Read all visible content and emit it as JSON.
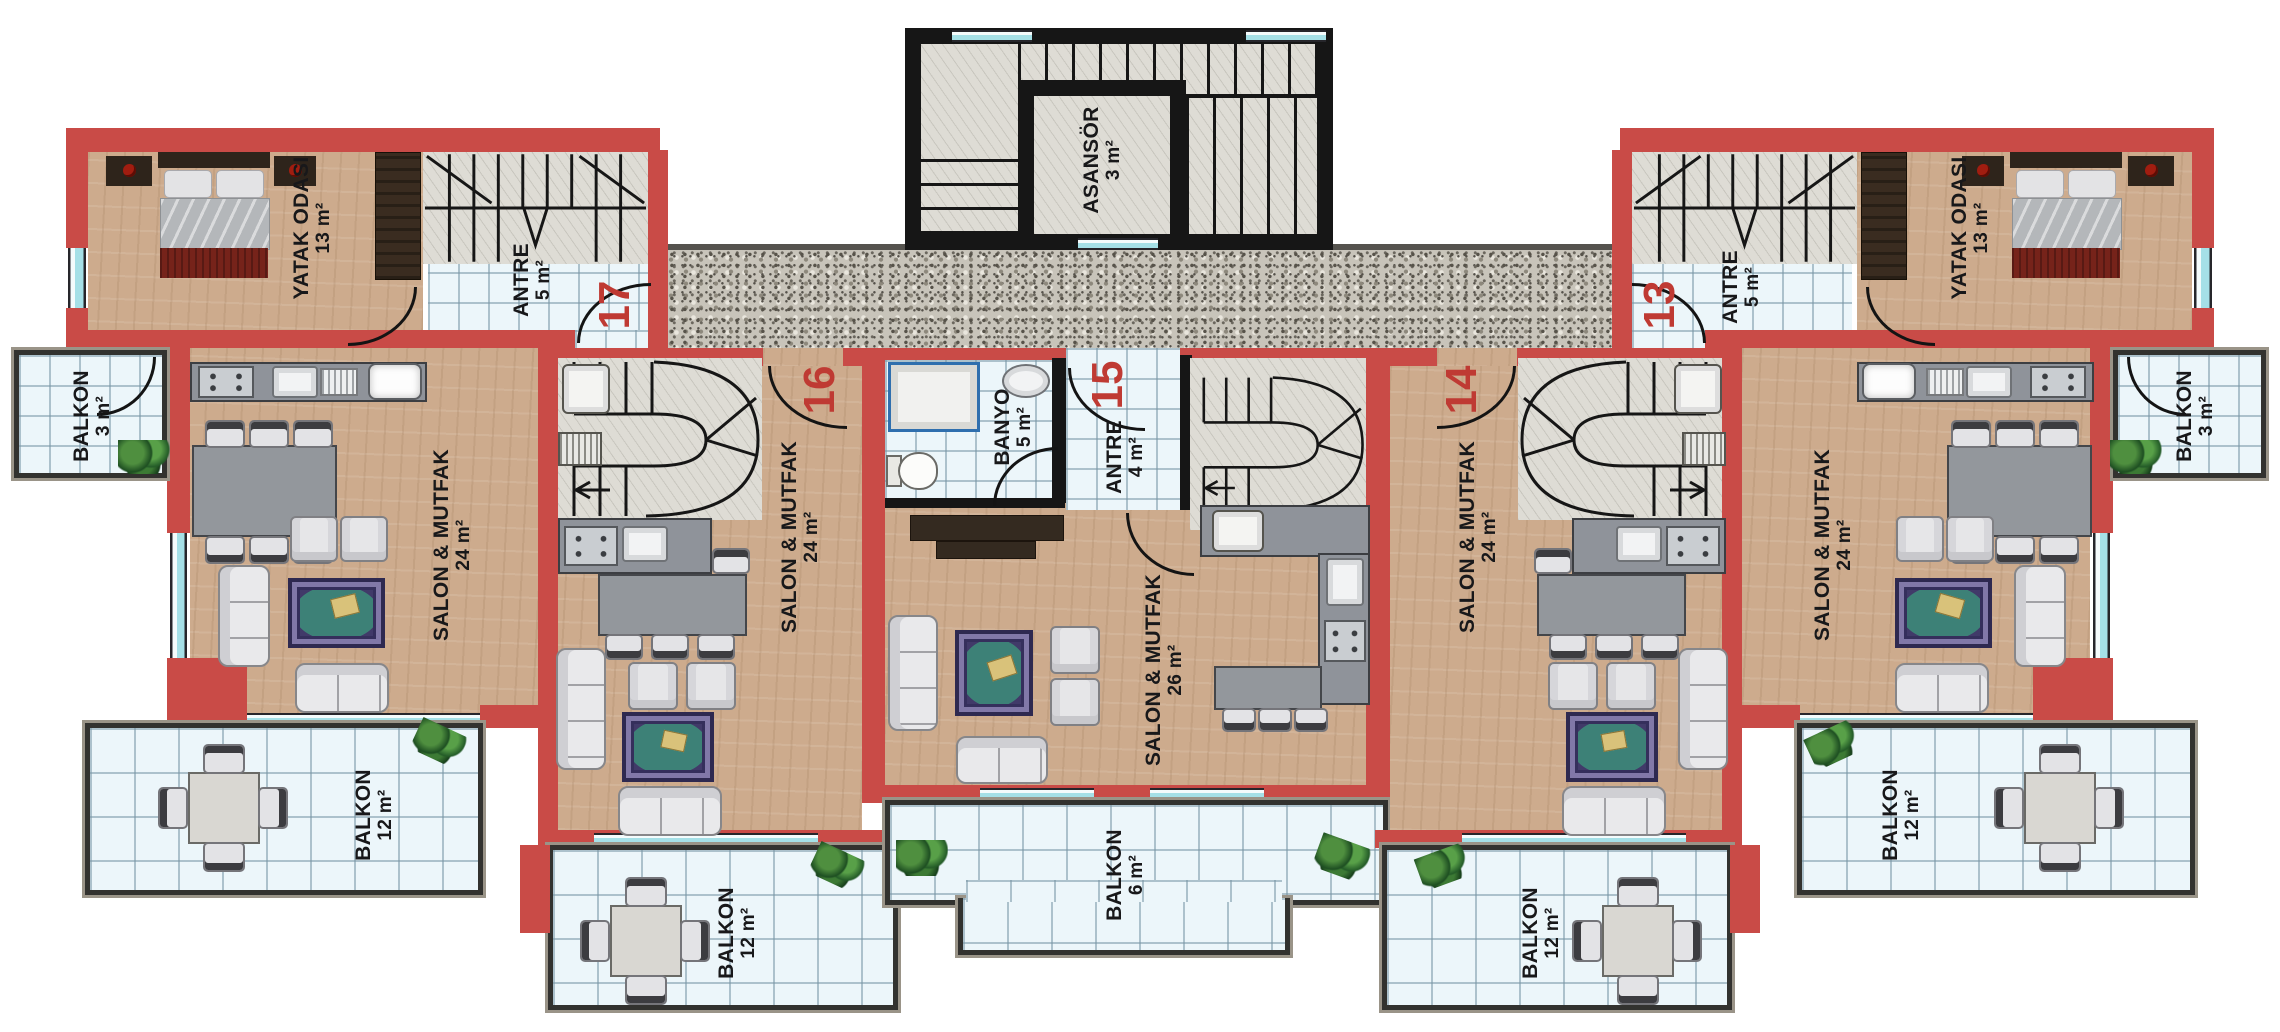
{
  "plan_title": "apartment-floor-plan",
  "colors": {
    "wall_red": "#c94b47",
    "wall_black": "#161616",
    "floor_tan": "#cdab8d",
    "tile_blue": "#ecf6fa",
    "granite_gray": "#c8c4ba",
    "window_cyan": "#a5e0e7",
    "unit_number_red": "#bf3a33"
  },
  "core": {
    "elevator": {
      "name": "ASANSÖR",
      "area": "3 m²"
    }
  },
  "units": [
    {
      "number": "17",
      "rooms": [
        {
          "name": "YATAK ODASI",
          "area": "13 m²"
        },
        {
          "name": "ANTRE",
          "area": "5 m²"
        },
        {
          "name": "SALON & MUTFAK",
          "area": "24 m²"
        },
        {
          "name": "BALKON",
          "area": "3 m²"
        },
        {
          "name": "BALKON",
          "area": "12 m²"
        }
      ]
    },
    {
      "number": "16",
      "rooms": [
        {
          "name": "SALON & MUTFAK",
          "area": "24 m²"
        },
        {
          "name": "BALKON",
          "area": "12 m²"
        }
      ]
    },
    {
      "number": "15",
      "rooms": [
        {
          "name": "BANYO",
          "area": "5 m²"
        },
        {
          "name": "ANTRE",
          "area": "4 m²"
        },
        {
          "name": "SALON & MUTFAK",
          "area": "26 m²"
        },
        {
          "name": "BALKON",
          "area": "6 m²"
        }
      ]
    },
    {
      "number": "14",
      "rooms": [
        {
          "name": "SALON & MUTFAK",
          "area": "24 m²"
        },
        {
          "name": "BALKON",
          "area": "12 m²"
        }
      ]
    },
    {
      "number": "13",
      "rooms": [
        {
          "name": "YATAK ODASI",
          "area": "13 m²"
        },
        {
          "name": "ANTRE",
          "area": "5 m²"
        },
        {
          "name": "SALON & MUTFAK",
          "area": "24 m²"
        },
        {
          "name": "BALKON",
          "area": "3 m²"
        },
        {
          "name": "BALKON",
          "area": "12 m²"
        }
      ]
    }
  ]
}
